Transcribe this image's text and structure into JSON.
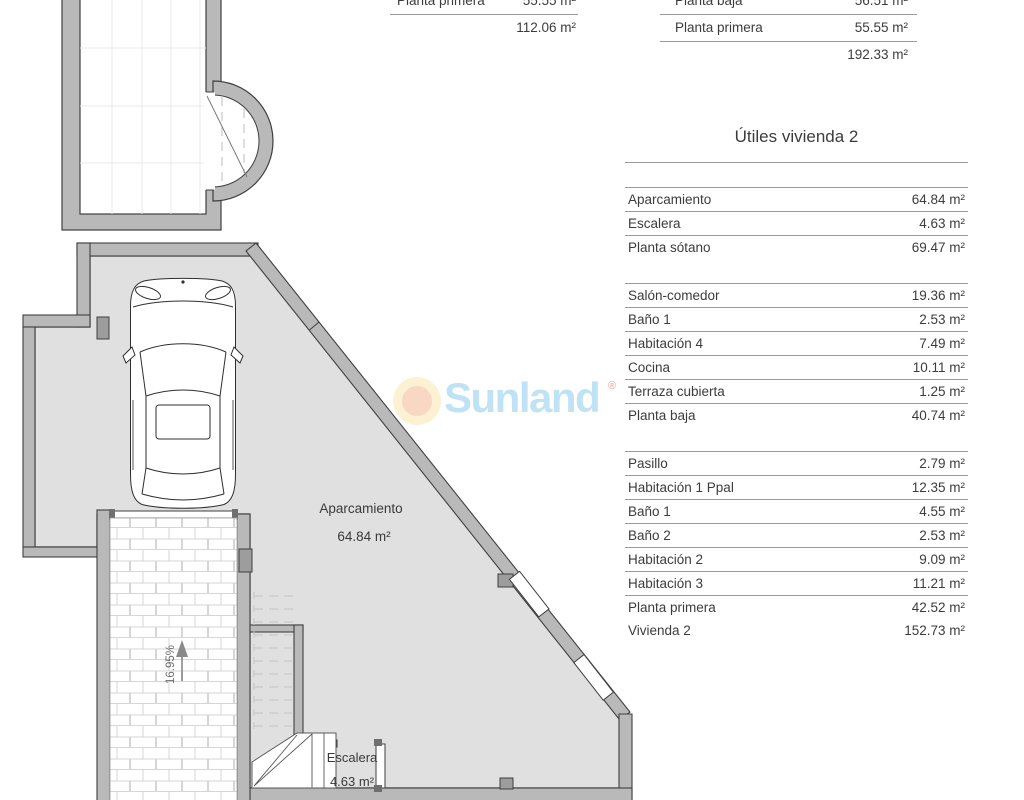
{
  "plan": {
    "labels": {
      "parking": "Aparcamiento",
      "parking_area": "64.84 m²",
      "stairs": "Escalera",
      "stairs_area": "4.63 m²",
      "ramp_slope": "16.95%"
    }
  },
  "watermark": {
    "brand": "Sunland",
    "registered": "®"
  },
  "tables": {
    "left_summary": {
      "rows": [
        {
          "label": "Planta primera",
          "value": "55.55 m²"
        }
      ],
      "total": "112.06 m²"
    },
    "right_summary": {
      "rows": [
        {
          "label": "Planta baja",
          "value": "56.51 m²"
        },
        {
          "label": "Planta primera",
          "value": "55.55 m²"
        }
      ],
      "total": "192.33 m²"
    },
    "utiles": {
      "title": "Útiles vivienda 2",
      "sections": [
        {
          "rows": [
            {
              "label": "Aparcamiento",
              "value": "64.84 m²"
            },
            {
              "label": "Escalera",
              "value": "4.63 m²"
            },
            {
              "label": "Planta sótano",
              "value": "69.47 m²"
            }
          ]
        },
        {
          "rows": [
            {
              "label": "Salón-comedor",
              "value": "19.36 m²"
            },
            {
              "label": "Baño 1",
              "value": "2.53 m²"
            },
            {
              "label": "Habitación 4",
              "value": "7.49 m²"
            },
            {
              "label": "Cocina",
              "value": "10.11 m²"
            },
            {
              "label": "Terraza cubierta",
              "value": "1.25 m²"
            },
            {
              "label": "Planta baja",
              "value": "40.74 m²"
            }
          ]
        },
        {
          "rows": [
            {
              "label": "Pasillo",
              "value": "2.79 m²"
            },
            {
              "label": "Habitación 1 Ppal",
              "value": "12.35 m²"
            },
            {
              "label": "Baño 1",
              "value": "4.55 m²"
            },
            {
              "label": "Baño 2",
              "value": "2.53 m²"
            },
            {
              "label": "Habitación 2",
              "value": "9.09 m²"
            },
            {
              "label": "Habitación 3",
              "value": "11.21 m²"
            },
            {
              "label": "Planta primera",
              "value": "42.52 m²"
            },
            {
              "label": "Vivienda 2",
              "value": "152.73 m²",
              "noline": true
            }
          ]
        }
      ]
    }
  },
  "colors": {
    "wall": "#b9b9b9",
    "wall_pillar": "#9d9d9d",
    "floor": "#e0e0e0",
    "outline": "#3f3f3f",
    "table_line": "#9b9b9b",
    "text": "#3c3c3c",
    "brand_blue": "#bfe2f4",
    "sun_outer": "#fcf2d3",
    "sun_inner": "#f8d8c3",
    "registered_pink": "#f2b3ab"
  }
}
